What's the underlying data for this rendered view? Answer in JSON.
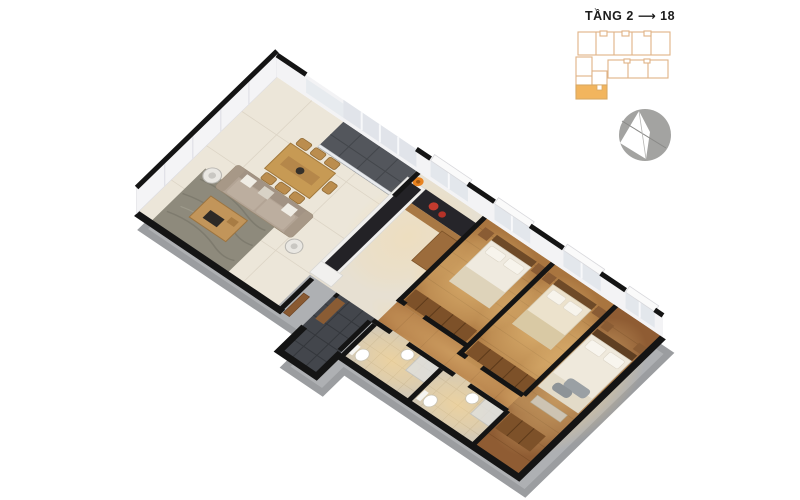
{
  "header": {
    "floor_label": "TẦNG 2 ⟶ 18"
  },
  "keyplan": {
    "highlight_color": "#F2B55E",
    "outline_color": "#DFB285"
  },
  "palette": {
    "wall_black": "#141414",
    "slab_gray": "#AEB0B3",
    "living_floor": "#ECE6D9",
    "wood_floor": "#A9753F",
    "master_wood": "#8F5C33",
    "bath_tile": "#D3C9B6",
    "entry_tile": "#43464C",
    "balcony_tile": "#53565C",
    "counter_dark": "#26252A",
    "sofa_taupe": "#B3A495",
    "wood_furniture": "#C79A54",
    "glow_warm": "#FFD98F"
  }
}
